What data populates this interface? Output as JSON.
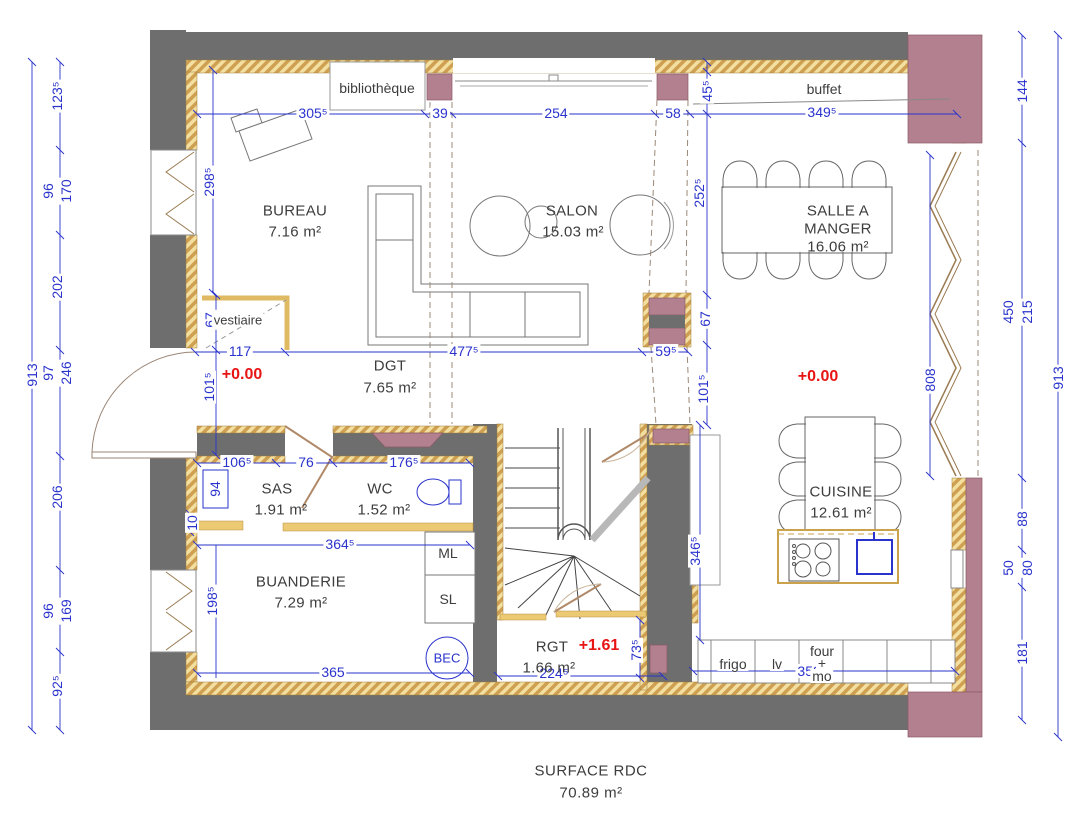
{
  "title": {
    "line1": "SURFACE RDC",
    "line2": "70.89 m²"
  },
  "rooms": {
    "bureau": {
      "name": "BUREAU",
      "area": "7.16 m²"
    },
    "salon": {
      "name": "SALON",
      "area": "15.03 m²"
    },
    "salle_a_manger": {
      "name1": "SALLE A",
      "name2": "MANGER",
      "area": "16.06 m²"
    },
    "dgt": {
      "name": "DGT",
      "area": "7.65 m²"
    },
    "sas": {
      "name": "SAS",
      "area": "1.91 m²"
    },
    "wc": {
      "name": "WC",
      "area": "1.52 m²"
    },
    "buanderie": {
      "name": "BUANDERIE",
      "area": "7.29 m²"
    },
    "cuisine": {
      "name": "CUISINE",
      "area": "12.61 m²"
    },
    "rgt": {
      "name": "RGT",
      "area": "1.66 m²"
    }
  },
  "fixtures": {
    "bibliotheque": "bibliothèque",
    "buffet": "buffet",
    "vestiaire": "vestiaire",
    "ml": "ML",
    "sl": "SL",
    "bec": "BEC",
    "frigo": "frigo",
    "lv": "lv",
    "four": "four",
    "plus": "+",
    "mo": "mo"
  },
  "levels": {
    "entry": "+0.00",
    "kitchen": "+0.00",
    "stair": "+1.61"
  },
  "dims": {
    "l_overall": "913",
    "l1": "123⁵",
    "l2a": "96",
    "l2b": "170",
    "l3": "202",
    "l4a": "97",
    "l4b": "246",
    "l5": "206",
    "l6a": "96",
    "l6b": "169",
    "l7": "92⁵",
    "r_overall": "913",
    "r1": "144",
    "r2a": "450",
    "r2b": "215",
    "r3": "88",
    "r4a": "50",
    "r4b": "80",
    "r5": "181",
    "t1": "305⁵",
    "t2": "39",
    "t3": "254",
    "t4": "58",
    "t5": "45⁵",
    "t6": "349⁵",
    "bureau_depth": "298⁵",
    "salon_right": "252⁵",
    "vestiaire_w": "117",
    "vestiaire_h": "67",
    "dgt_w": "477⁵",
    "post_w": "59⁵",
    "post_h": "67",
    "entry_h": "101⁵",
    "dining_h": "101⁵",
    "glazing_h": "808",
    "sas_w": "106⁵",
    "sas_door": "76",
    "wc_w": "176⁵",
    "sas_win_h": "94",
    "sas_sill": "10",
    "wc_row_w": "364⁵",
    "buanderie_h": "198⁵",
    "buanderie_w": "365",
    "rgt_w": "224⁵",
    "rgt_h": "73⁵",
    "cuisine_h": "346⁵",
    "cuisine_w": "352⁵"
  },
  "colors": {
    "dimension_blue": "#2a33cc",
    "level_red": "#e81515",
    "wall_gray": "#6e6e6e",
    "post_pink": "#b2808f",
    "insulation_yellow": "#e9c76f"
  }
}
